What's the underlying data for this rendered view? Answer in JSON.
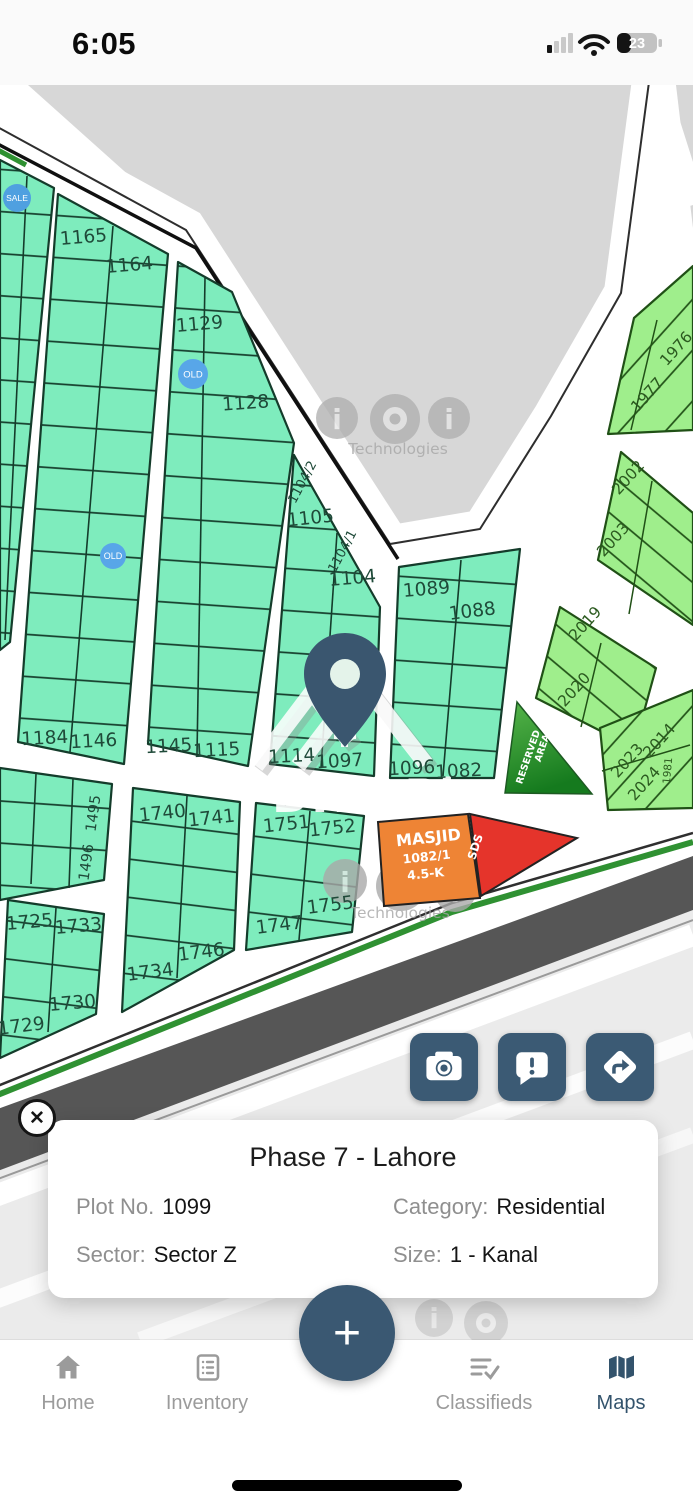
{
  "status_bar": {
    "time": "6:05",
    "battery_percent": "23"
  },
  "map": {
    "watermark": {
      "brand": "DHA Plus",
      "tech": "Technologies"
    },
    "badges": {
      "sale": "SALE",
      "old_1": "OLD",
      "old_2": "OLD"
    },
    "areas": {
      "masjid_line1": "MASJID",
      "masjid_line2": "1082/1",
      "masjid_line3": "4.5-K",
      "sds": "SDS",
      "reserved_line1": "RESERVED",
      "reserved_line2": "AREA"
    },
    "plots": {
      "1165": "1165",
      "1164": "1164",
      "1129": "1129",
      "1128": "1128",
      "1104_2": "1104/2",
      "1105": "1105",
      "1104_1": "1104/1",
      "1104": "1104",
      "1089": "1089",
      "1088": "1088",
      "1184": "1184",
      "1146": "1146",
      "1145": "1145",
      "1115": "1115",
      "1114": "1114",
      "1097": "1097",
      "1096": "1096",
      "1082": "1082",
      "1495": "1495",
      "1496": "1496",
      "1740": "1740",
      "1741": "1741",
      "1751": "1751",
      "1752": "1752",
      "1755": "1755",
      "1747": "1747",
      "1746": "1746",
      "1734": "1734",
      "1725": "1725",
      "1733": "1733",
      "1730": "1730",
      "1729": "1729",
      "1976": "1976",
      "1977": "1977",
      "2002": "2002",
      "2003": "2003",
      "2019": "2019",
      "2020": "2020",
      "2023": "2023",
      "2014": "2014",
      "2024": "2024",
      "1981": "1981"
    }
  },
  "action_buttons": {
    "icons": [
      "camera",
      "report-comment",
      "directions"
    ]
  },
  "info_card": {
    "title": "Phase 7 - Lahore",
    "fields": [
      {
        "label": "Plot No.",
        "value": "1099"
      },
      {
        "label": "Category:",
        "value": "Residential"
      },
      {
        "label": "Sector:",
        "value": "Sector Z"
      },
      {
        "label": "Size:",
        "value": "1 - Kanal"
      }
    ]
  },
  "fab": {
    "label": "+"
  },
  "nav": {
    "items": [
      {
        "label": "Home",
        "active": false
      },
      {
        "label": "Inventory",
        "active": false
      },
      {
        "label": "Classifieds",
        "active": false
      },
      {
        "label": "Maps",
        "active": true
      }
    ]
  },
  "colors": {
    "accent_slate": "#3A5872",
    "plot_mint": "#7EECBD",
    "plot_green": "#9FEE8C",
    "masjid_orange": "#EE8435",
    "sds_red": "#E5342B",
    "reserved_green": "#2e7d32",
    "badge_blue": "#54A3E6",
    "boulevard_green": "#2F9132",
    "road_dark": "#565656"
  }
}
